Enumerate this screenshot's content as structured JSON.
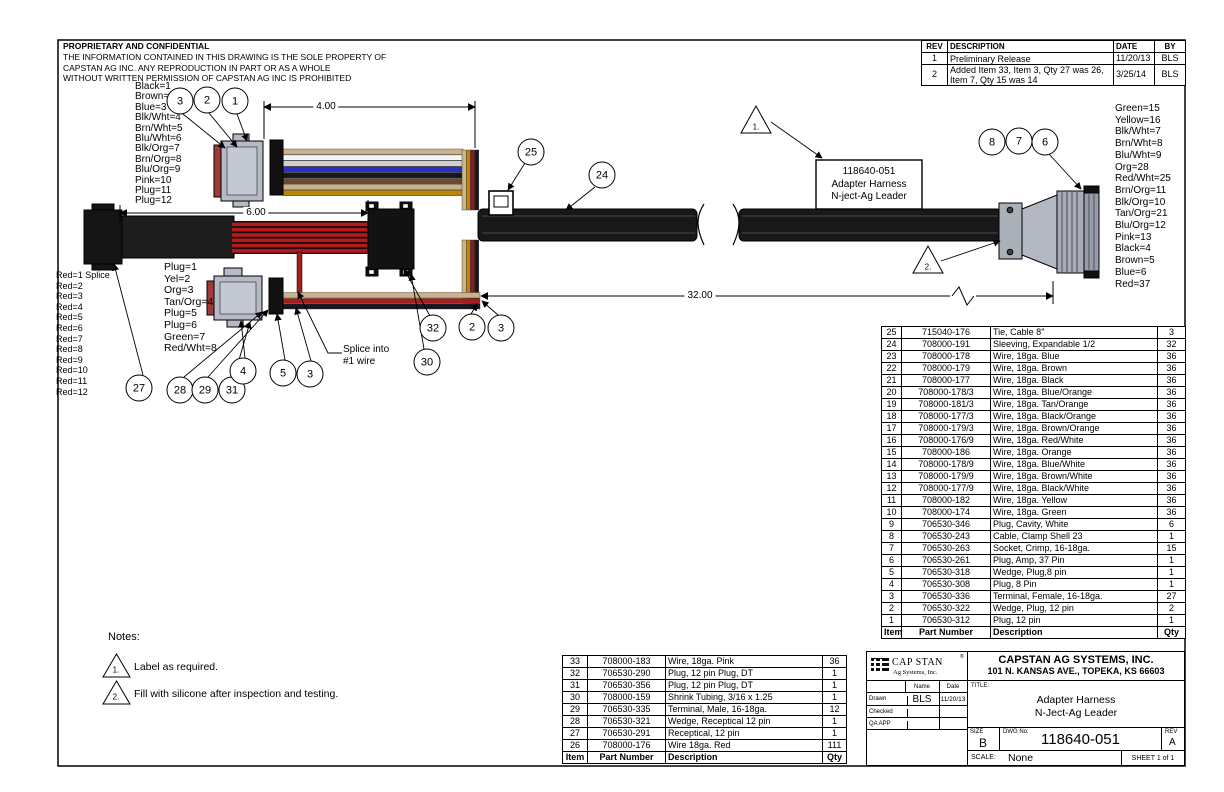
{
  "drawing": {
    "proprietary_title": "PROPRIETARY AND CONFIDENTIAL",
    "proprietary_lines": [
      "THE INFORMATION CONTAINED IN THIS DRAWING IS THE SOLE PROPERTY OF",
      "CAPSTAN AG INC. ANY REPRODUCTION IN PART OR AS A WHOLE",
      "WITHOUT WRITTEN PERMISSION OF CAPSTAN AG INC IS PROHIBITED"
    ],
    "dim_4": "4.00",
    "dim_6": "6.00",
    "dim_32": "32.00",
    "label_box_lines": [
      "118640-051",
      "Adapter Harness",
      "N-ject-Ag Leader"
    ],
    "splice_note_lines": [
      "Splice into",
      "#1 wire"
    ],
    "flag_1": "1.",
    "flag_2": "2.",
    "wire_labels_top_left": [
      "Black=1",
      "Brown=2",
      "Blue=3",
      "Blk/Wht=4",
      "Brn/Wht=5",
      "Blu/Wht=6",
      "Blk/Org=7",
      "Brn/Org=8",
      "Blu/Org=9",
      "Pink=10",
      "Plug=11",
      "Plug=12"
    ],
    "wire_labels_right": [
      "Green=15",
      "Yellow=16",
      "Blk/Wht=7",
      "Brn/Wht=8",
      "Blu/Wht=9",
      "Org=28",
      "Red/Wht=25",
      "Brn/Org=11",
      "Blk/Org=10",
      "Tan/Org=21",
      "Blu/Org=12",
      "Pink=13",
      "Black=4",
      "Brown=5",
      "Blue=6",
      "Red=37"
    ],
    "wire_labels_red": [
      "Red=1 Splice",
      "Red=2",
      "Red=3",
      "Red=4",
      "Red=5",
      "Red=6",
      "Red=7",
      "Red=8",
      "Red=9",
      "Red=10",
      "Red=11",
      "Red=12"
    ],
    "wire_labels_plug": [
      "Plug=1",
      "Yel=2",
      "Org=3",
      "Tan/Org=4",
      "Plug=5",
      "Plug=6",
      "Green=7",
      "Red/Wht=8"
    ],
    "balloons": [
      "3",
      "2",
      "1",
      "25",
      "24",
      "8",
      "7",
      "6",
      "27",
      "28",
      "29",
      "31",
      "4",
      "5",
      "3",
      "32",
      "2",
      "3",
      "30"
    ]
  },
  "notes": {
    "heading": "Notes:",
    "items": [
      {
        "num": "1.",
        "text": "Label as required."
      },
      {
        "num": "2.",
        "text": "Fill with silicone after inspection and testing."
      }
    ]
  },
  "rev_table": {
    "headers": [
      "REV",
      "DESCRIPTION",
      "DATE",
      "BY"
    ],
    "rows": [
      [
        "1",
        "Preliminary Release",
        "11/20/13",
        "BLS"
      ],
      [
        "2",
        "Added Item 33, Item 3, Qty 27 was 26, Item 7, Qty 15 was 14",
        "3/25/14",
        "BLS"
      ]
    ]
  },
  "bom_main": {
    "footer": [
      "Item",
      "Part Number",
      "Description",
      "Qty"
    ],
    "rows": [
      [
        "25",
        "715040-176",
        "Tie, Cable 8\"",
        "3"
      ],
      [
        "24",
        "708000-191",
        "Sleeving, Expandable 1/2",
        "32"
      ],
      [
        "23",
        "708000-178",
        "Wire, 18ga. Blue",
        "36"
      ],
      [
        "22",
        "708000-179",
        "Wire, 18ga. Brown",
        "36"
      ],
      [
        "21",
        "708000-177",
        "Wire, 18ga. Black",
        "36"
      ],
      [
        "20",
        "708000-178/3",
        "Wire, 18ga. Blue/Orange",
        "36"
      ],
      [
        "19",
        "708000-181/3",
        "Wire, 18ga. Tan/Orange",
        "36"
      ],
      [
        "18",
        "708000-177/3",
        "Wire, 18ga. Black/Orange",
        "36"
      ],
      [
        "17",
        "708000-179/3",
        "Wire, 18ga. Brown/Orange",
        "36"
      ],
      [
        "16",
        "708000-176/9",
        "Wire, 18ga. Red/White",
        "36"
      ],
      [
        "15",
        "708000-186",
        "Wire, 18ga. Orange",
        "36"
      ],
      [
        "14",
        "708000-178/9",
        "Wire, 18ga. Blue/White",
        "36"
      ],
      [
        "13",
        "708000-179/9",
        "Wire, 18ga. Brown/White",
        "36"
      ],
      [
        "12",
        "708000-177/9",
        "Wire, 18ga. Black/White",
        "36"
      ],
      [
        "11",
        "708000-182",
        "Wire, 18ga. Yellow",
        "36"
      ],
      [
        "10",
        "708000-174",
        "Wire, 18ga. Green",
        "36"
      ],
      [
        "9",
        "706530-346",
        "Plug, Cavity, White",
        "6"
      ],
      [
        "8",
        "706530-243",
        "Cable, Clamp Shell 23",
        "1"
      ],
      [
        "7",
        "706530-263",
        "Socket, Crimp, 16-18ga.",
        "15"
      ],
      [
        "6",
        "706530-261",
        "Plug, Amp, 37 Pin",
        "1"
      ],
      [
        "5",
        "706530-318",
        "Wedge, Plug,8 pin",
        "1"
      ],
      [
        "4",
        "706530-308",
        "Plug, 8 Pin",
        "1"
      ],
      [
        "3",
        "706530-336",
        "Terminal, Female, 16-18ga.",
        "27"
      ],
      [
        "2",
        "706530-322",
        "Wedge, Plug, 12 pin",
        "2"
      ],
      [
        "1",
        "706530-312",
        "Plug, 12 pin",
        "1"
      ]
    ]
  },
  "bom_secondary": {
    "footer": [
      "Item",
      "Part Number",
      "Description",
      "Qty"
    ],
    "rows": [
      [
        "33",
        "708000-183",
        "Wire, 18ga. Pink",
        "36"
      ],
      [
        "32",
        "706530-290",
        "Plug, 12 pin Plug, DT",
        "1"
      ],
      [
        "31",
        "706530-356",
        "Plug, 12 pin Plug, DT",
        "1"
      ],
      [
        "30",
        "708000-159",
        "Shrink Tubing, 3/16 x 1.25",
        "1"
      ],
      [
        "29",
        "706530-335",
        "Terminal, Male, 16-18ga.",
        "12"
      ],
      [
        "28",
        "706530-321",
        "Wedge, Receptical 12 pin",
        "1"
      ],
      [
        "27",
        "706530-291",
        "Receptical, 12 pin",
        "1"
      ],
      [
        "26",
        "708000-176",
        "Wire 18ga. Red",
        "111"
      ]
    ]
  },
  "title_block": {
    "logo_main": "CAP STAN",
    "logo_sub": "Ag Systems, Inc.",
    "logo_reg": "®",
    "company": "CAPSTAN AG SYSTEMS, INC.",
    "address": "101 N. KANSAS AVE., TOPEKA, KS 66603",
    "col_name": "Name",
    "col_date": "Date",
    "drawn_label": "Drawn",
    "drawn_name": "BLS",
    "drawn_date": "11/20/13",
    "checked_label": "Checked",
    "qa_label": "QA APP",
    "title_label": "TITLE:",
    "title_line1": "Adapter Harness",
    "title_line2": "N-Ject-Ag Leader",
    "size_label": "SIZE",
    "size": "B",
    "dwg_label": "DWG No:",
    "dwg_no": "118640-051",
    "rev_label": "REV",
    "rev": "A",
    "scale_label": "SCALE:",
    "scale": "None",
    "sheet": "SHEET 1 of 1"
  }
}
